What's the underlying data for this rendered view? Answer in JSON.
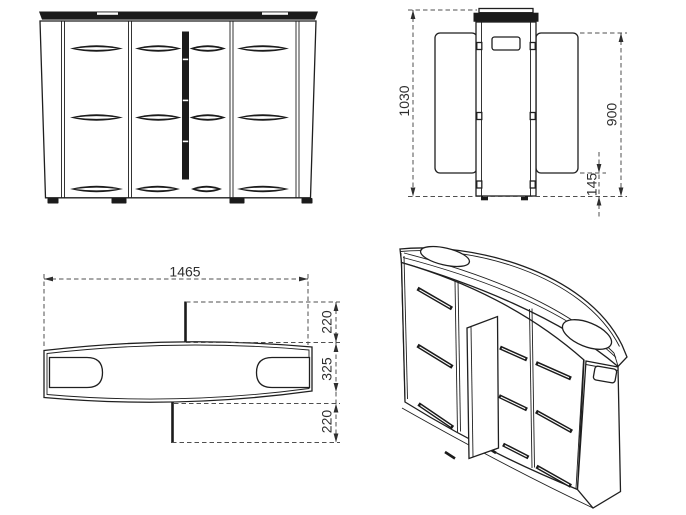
{
  "drawing": {
    "colors": {
      "background": "#ffffff",
      "line": "#1f1f1f",
      "dim_line": "#4f4f4f",
      "dark_fill": "#1b1b1b",
      "label": "#2e2e2e"
    },
    "labels": {
      "total_height": "1030",
      "panel_height": "900",
      "bottom_offset": "145",
      "total_width": "1465",
      "swing_top": "220",
      "depth": "325",
      "swing_bottom": "220"
    }
  }
}
